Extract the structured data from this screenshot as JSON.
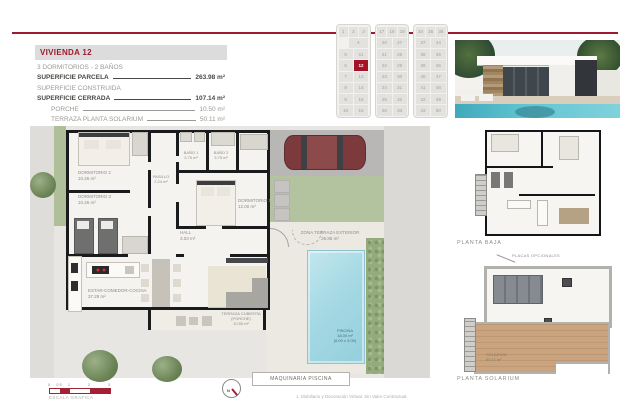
{
  "palette": {
    "accent": "#9c1b30",
    "highlight": "#a31227",
    "pool": "#a5d9e4",
    "grass": "#b3c29f",
    "wood": "#c9a47f"
  },
  "spec": {
    "title": "VIVIENDA 12",
    "line1": "3 DORMITORIOS - 2 BAÑOS",
    "rows": [
      {
        "label": "SUPERFICIE PARCELA",
        "value": "263.98 m²"
      },
      {
        "label": "SUPERFICIE CONSTRUIDA",
        "value": ""
      },
      {
        "label": "SUPERFICIE CERRADA",
        "value": "107.14 m²"
      },
      {
        "label": "PORCHE",
        "value": "10.50 m²"
      },
      {
        "label": "TERRAZA PLANTA SOLARIUM",
        "value": "50.11 m²"
      }
    ],
    "total": {
      "label": "TOTAL VIVIENDA",
      "value": "167.75 m²"
    },
    "extra": {
      "label": "ZONA TERRAZA EXTERIOR",
      "value": "26.86 m²"
    }
  },
  "site_grid": {
    "highlight": "12",
    "blocks": [
      {
        "top": [
          "1",
          "2",
          "3"
        ],
        "wide": "4",
        "left": [
          "5",
          "6",
          "7",
          "8",
          "9",
          "10"
        ],
        "right": [
          "11",
          "12",
          "13",
          "14",
          "15",
          "16"
        ]
      },
      {
        "top": [
          "17",
          "18",
          "19"
        ],
        "left": [
          "20",
          "21",
          "22",
          "23",
          "24",
          "25",
          "26"
        ],
        "right": [
          "27",
          "28",
          "29",
          "30",
          "31",
          "32",
          "33"
        ]
      },
      {
        "top": [
          "34",
          "35",
          "36"
        ],
        "left": [
          "37",
          "38",
          "39",
          "40",
          "41",
          "42",
          "43"
        ],
        "right": [
          "44",
          "45",
          "46",
          "47",
          "48",
          "49",
          "50"
        ]
      }
    ]
  },
  "plan": {
    "rooms": {
      "dormitorio2": {
        "name": "DORMITORIO 2",
        "area": "10.26 m²"
      },
      "dormitorio3": {
        "name": "DORMITORIO 3",
        "area": "10.26 m²"
      },
      "dormitorio1": {
        "name": "DORMITORIO 1",
        "area": "12.00 m²"
      },
      "bano1": {
        "name": "BAÑO 1",
        "area": "3.75 m²"
      },
      "bano2": {
        "name": "BAÑO 2",
        "area": "3.75 m²"
      },
      "pasillo": {
        "name": "PASILLO",
        "area": "2.24 m²"
      },
      "hall": {
        "name": "HALL",
        "area": "3.03 m²"
      },
      "estar": {
        "name": "ESTAR-COMEDOR-COCINA",
        "area": "37.29 m²"
      },
      "porche": {
        "name": "TERRAZA CUBIERTA (PORCHE)",
        "area": "10.50 m²"
      },
      "zona": {
        "name": "ZONA TERRAZA EXTERIOR",
        "area": "26.86 m²"
      },
      "piscina": {
        "name": "PISCINA",
        "area": "18.00 m²",
        "dims": "(6.00 x 3.00)"
      }
    },
    "maquinaria": "MAQUINARIA PISCINA",
    "escala": "ESCALA GRAFICA",
    "scale_ticks": [
      "0",
      "0.5",
      "1",
      "2",
      "3"
    ],
    "north": "N",
    "disclaimer": "1. Mobiliario y Decoración Virtual. Sin Valor Contractual."
  },
  "mini_plans": {
    "planta_baja": "PLANTA BAJA",
    "placas": "PLACAS OPCIONALES",
    "solarium_label": "PLANTA SOLARIUM",
    "solarium_room": {
      "name": "SOLARIUM",
      "area": "50.11 m²"
    }
  }
}
